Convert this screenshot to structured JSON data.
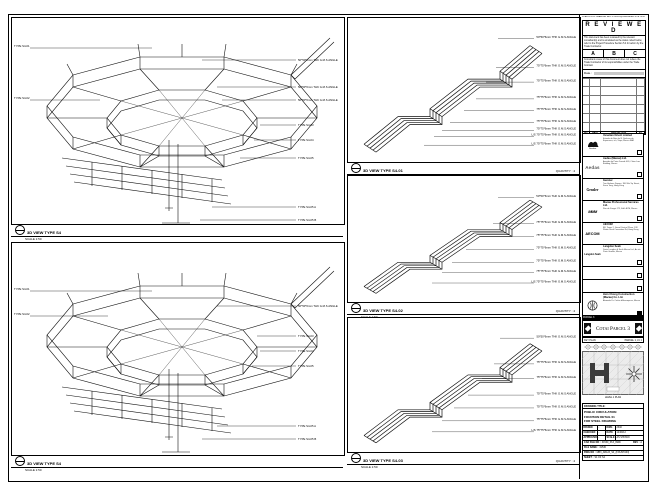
{
  "stamp": {
    "received_line": "30 AUG 2012 DRAWING REC'D 0932 by ENGINEER SITE OFFICE",
    "title": "R E V I E W E D",
    "body1": "This document has been reviewed by the relevant consultant(s) and is annotated as the status noted below, refer to the Project Procedure Section 5.4 for action by the Trade Contractor.",
    "options": [
      "A",
      "B",
      "C"
    ],
    "body2": "Consultant review of this document does not relieve the Trade Contractor of its responsibilities under the Trade Contract.",
    "date_label": "Date :"
  },
  "rev_table": {
    "headers": [
      "NO.",
      "DATE",
      "DESCRIPTION",
      "BY"
    ]
  },
  "consultants": [
    {
      "logo_text": "Venetian",
      "name": "Venetian Orient Limited",
      "address": "Estrada da Baia de N. Senhora da Esperanca, s/n, Taipa, Macau SAR"
    },
    {
      "logo_text": "Aedas",
      "name": "Aedas (Macau) Ltd.",
      "address": "Avenida da Praia Grande 409, China Law Building, Macau"
    },
    {
      "logo_text": "Gensler",
      "name": "Gensler",
      "address": "Two Harbour Square, 180 Wai Yip Street, Kwun Tong, Hong Kong"
    },
    {
      "logo_text": "MMM",
      "name": "Macau Professional Services Ltd.",
      "address": "Rua de Xangai 175, Edif. ACM, Macau"
    },
    {
      "logo_text": "AECOM",
      "name": "AECOM",
      "address": "8/F, Tower 2, Grand Central Plaza, 138 Shatin Rural Committee Rd, Hong Kong"
    },
    {
      "logo_text": "Langdon Seah",
      "name": "Langdon Seah",
      "address": "Davis Langdon & Seah Macau Ltd., Av. da Praia Grande, Macau"
    },
    {
      "name": "",
      "address": ""
    },
    {
      "name": "",
      "address": ""
    },
    {
      "name": "Hsin Chong Construction (Macau) Co. Ltd.",
      "address": "Alameda Dr. Carlos d'Assumpcao, Macau"
    }
  ],
  "banner": {
    "text": "Cotai Parcel 3"
  },
  "key_plan": {
    "bar_text": "PARCEL 3",
    "header_left": "KEY PLAN",
    "header_right": "PARCEL 1, LV 1",
    "caption": "LEVEL 1 PLAN"
  },
  "title_block": {
    "drawing_title_label": "DRAWING TITLE:",
    "title_lines": [
      "PUBLIC CIRCULATION",
      "FOUNTAIN DETAIL 01",
      "FOR STEEL DRAWING"
    ],
    "fields": [
      {
        "label": "DRAWN",
        "value": "-",
        "label2": "DWG",
        "value2": "2340"
      },
      {
        "label": "CHECKED",
        "value": "-",
        "label2": "DATE",
        "value2": "14/09/12"
      },
      {
        "label": "APPROVED",
        "value": "-",
        "label2": "SCALE",
        "value2": "AS SHOWN"
      }
    ],
    "cad_file_label": "CAD FILE NO :",
    "cad_file": "31530_P13_9999",
    "rev_label": "REV :",
    "rev": "A",
    "file_name_label": "FILE NAME :",
    "file_name": "31530",
    "dwg_no_label": "DWG NO :",
    "dwg_no": "MB3_AB123_S4_(FOUNTAIN)",
    "sheet_label": "SHEET :",
    "sheet": "S4 OF S4"
  },
  "panels": {
    "p1": {
      "title": "3D VIEW TYPE S4",
      "scale": "SCALE 1:50",
      "left": [
        "TYPE S4-01",
        "TYPE S4-02"
      ],
      "right": [
        "50*50*6mm THK G.M.S ANGLE",
        "50*50*6mm THK G.M.S ANGLE",
        "50*50*6mm THK G.M.S ANGLE",
        "TYPE S4-03",
        "TYPE S4-04",
        "TYPE S4-05",
        "TYPE S4-05 A",
        "TYPE S4-05 B"
      ]
    },
    "p2": {
      "title": "3D VIEW TYPE S4",
      "scale": "SCALE 1:50",
      "left": [
        "TYPE S4-01",
        "TYPE S4-02"
      ],
      "right": [
        "50*50*6mm THK G.M.S ANGLE",
        "TYPE S4-03",
        "TYPE S4-04",
        "TYPE S4-05",
        "TYPE S4-05 A",
        "TYPE S4-05 B"
      ]
    },
    "m1": {
      "title": "3D VIEW TYPE S4-01",
      "scale": "SCALE 1:50",
      "quantity": "QUANTITY : 4",
      "right": [
        "50*50*6mm THK G.M.S ANGLE",
        "75*75*6mm THK G.M.S ANGLE",
        "75*75*6mm THK G.M.S ANGLE",
        "75*75*6mm THK G.M.S ANGLE",
        "75*75*6mm THK G.M.S ANGLE",
        "75*75*6mm THK G.M.S ANGLE",
        "75*75*6mm THK G.M.S ANGLE",
        "L/S 75*75*6mm THK G.M.S ANGLE",
        "L/S 75*75*6mm THK G.M.S ANGLE"
      ]
    },
    "m2": {
      "title": "3D VIEW TYPE S4-02",
      "scale": "SCALE 1:50",
      "quantity": "QUANTITY : 4",
      "right": [
        "50*50*6mm THK G.M.S ANGLE",
        "75*75*6mm THK G.M.S ANGLE",
        "75*75*6mm THK G.M.S ANGLE",
        "75*75*6mm THK G.M.S ANGLE",
        "75*75*6mm THK G.M.S ANGLE",
        "75*75*6mm THK G.M.S ANGLE",
        "L/S 75*75*6mm THK G.M.S ANGLE"
      ]
    },
    "m3": {
      "title": "3D VIEW TYPE S4-03",
      "scale": "SCALE 1:50",
      "quantity": "QUANTITY : 4",
      "right": [
        "50*50*6mm THK G.M.S ANGLE",
        "75*75*6mm THK G.M.S ANGLE",
        "75*75*6mm THK G.M.S ANGLE",
        "75*75*6mm THK G.M.S ANGLE",
        "75*75*6mm THK G.M.S ANGLE",
        "75*75*6mm THK G.M.S ANGLE",
        "L/S 75*75*6mm THK G.M.S ANGLE"
      ]
    }
  }
}
